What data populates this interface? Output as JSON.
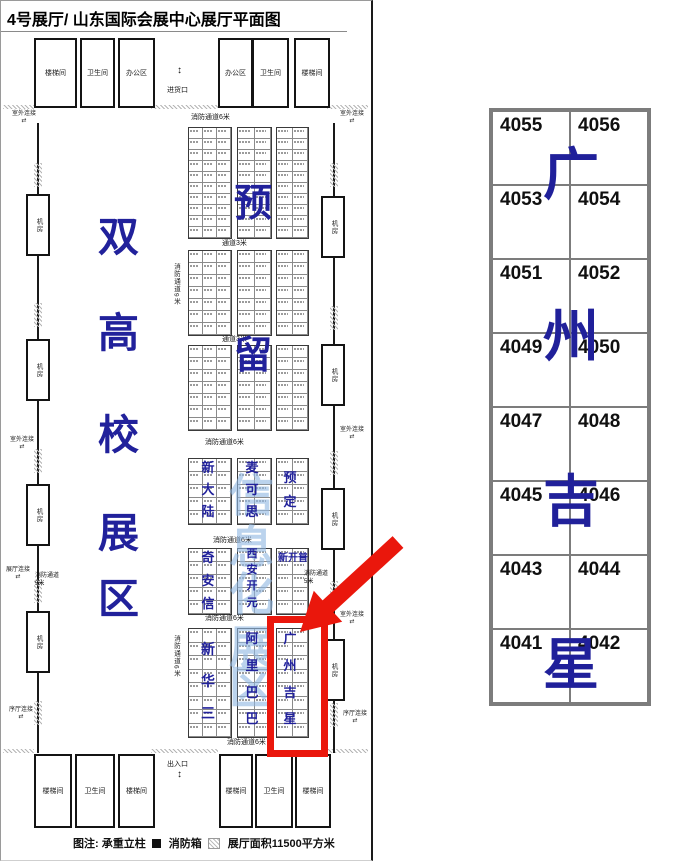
{
  "title": "4号展厅/ 山东国际会展中心展厅平面图",
  "colors": {
    "company_blue": "#21219b",
    "watermark_blue": "#92b8e2",
    "highlight_red": "#ea170c"
  },
  "floorplan": {
    "top_rooms": [
      "楼梯间",
      "卫生间",
      "办公区",
      "办公区",
      "卫生间",
      "楼梯间"
    ],
    "bottom_rooms": [
      "楼梯间",
      "卫生间",
      "楼梯间",
      "楼梯间",
      "卫生间",
      "楼梯间"
    ],
    "loading_door": "进货口",
    "exit_door": "出入口",
    "machine_room": "机房",
    "zone_title": "双高校展区",
    "watermark": "信息化展区",
    "labels": {
      "fire_lane_6m": "消防通道6米",
      "fire_lane_9m": "消防通道9米",
      "fire_lane_5m": "消防通道5米",
      "aisle_3m": "通道3米",
      "outdoor_link": "室外连接",
      "hall_link": "展厅连接",
      "lobby_link": "序厅连接"
    },
    "sections": [
      {
        "aisle_above": "消防通道6米",
        "rows": 10,
        "overlays": [
          "",
          "预",
          ""
        ]
      },
      {
        "aisle_above": "通道3米",
        "rows": 7,
        "overlays": [
          "",
          "",
          ""
        ]
      },
      {
        "aisle_above": "通道3米",
        "rows": 7,
        "overlays": [
          "",
          "留",
          ""
        ]
      },
      {
        "aisle_above": "消防通道6米",
        "rows": 5,
        "overlays": [
          "新大陆",
          "麦可思",
          "预定"
        ]
      },
      {
        "aisle_above": "消防通道6米",
        "rows": 5,
        "overlays": [
          "奇安信",
          "西安开元",
          "新开普"
        ]
      },
      {
        "aisle_above": "消防通道6米",
        "aisle_below": "消防通道6米",
        "rows": 8,
        "overlays": [
          "新华三",
          "阿里巴巴",
          "广州吉星"
        ],
        "highlighted_block": "广州吉星"
      }
    ],
    "legend": {
      "label": "图注: 承重立柱",
      "fire_box": "消防箱",
      "area": "展厅面积11500平方米"
    }
  },
  "detail": {
    "rows": [
      [
        "4055",
        "4056"
      ],
      [
        "4053",
        "4054"
      ],
      [
        "4051",
        "4052"
      ],
      [
        "4049",
        "4050"
      ],
      [
        "4047",
        "4048"
      ],
      [
        "4045",
        "4046"
      ],
      [
        "4043",
        "4044"
      ],
      [
        "4041",
        "4042"
      ]
    ],
    "overlay": "广州吉星"
  }
}
